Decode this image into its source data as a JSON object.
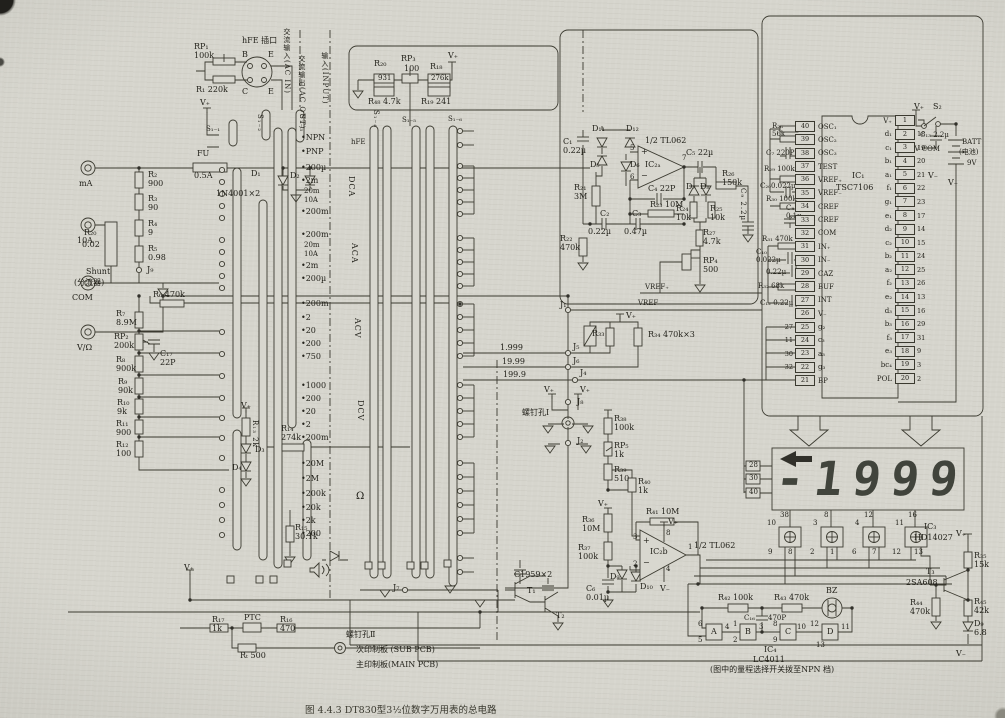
{
  "caption": "图 4.4.3   DT830型3½位数字万用表的总电路",
  "lcd": {
    "model": "LD-B7015A 型",
    "label": "LCD",
    "reading": "-1999"
  },
  "ic1": {
    "name": "IC₁",
    "part": "TSC7106",
    "left_pins": [
      {
        "n": "40",
        "l": "OSC₁"
      },
      {
        "n": "39",
        "l": "OSC₂"
      },
      {
        "n": "38",
        "l": "OSC₃"
      },
      {
        "n": "37",
        "l": "TEST"
      },
      {
        "n": "36",
        "l": "VREF₊"
      },
      {
        "n": "35",
        "l": "VREF₋"
      },
      {
        "n": "34",
        "l": "CREF"
      },
      {
        "n": "33",
        "l": "CREF"
      },
      {
        "n": "32",
        "l": "COM"
      },
      {
        "n": "31",
        "l": "IN₊"
      },
      {
        "n": "30",
        "l": "IN₋"
      },
      {
        "n": "29",
        "l": "CAZ"
      },
      {
        "n": "28",
        "l": "BUF"
      },
      {
        "n": "27",
        "l": "INT"
      },
      {
        "n": "26",
        "l": "V₋"
      },
      {
        "n": "25",
        "l": "g₂",
        "e": "27"
      },
      {
        "n": "24",
        "l": "c₃",
        "e": "11"
      },
      {
        "n": "23",
        "l": "a₃",
        "e": "30"
      },
      {
        "n": "22",
        "l": "g₃",
        "e": "32"
      },
      {
        "n": "21",
        "l": "BP"
      }
    ],
    "right_pins": [
      {
        "n": "1",
        "l": "V₊"
      },
      {
        "n": "2",
        "l": "d₁",
        "e": "18"
      },
      {
        "n": "3",
        "l": "c₁",
        "e": "19"
      },
      {
        "n": "4",
        "l": "b₁",
        "e": "20"
      },
      {
        "n": "5",
        "l": "a₁",
        "e": "21"
      },
      {
        "n": "6",
        "l": "f₁",
        "e": "22"
      },
      {
        "n": "7",
        "l": "g₁",
        "e": "23"
      },
      {
        "n": "8",
        "l": "e₁",
        "e": "17"
      },
      {
        "n": "9",
        "l": "d₂",
        "e": "14"
      },
      {
        "n": "10",
        "l": "c₂",
        "e": "15"
      },
      {
        "n": "11",
        "l": "b₂",
        "e": "24"
      },
      {
        "n": "12",
        "l": "a₂",
        "e": "25"
      },
      {
        "n": "13",
        "l": "f₂",
        "e": "26"
      },
      {
        "n": "14",
        "l": "e₂",
        "e": "13"
      },
      {
        "n": "15",
        "l": "d₃",
        "e": "16"
      },
      {
        "n": "16",
        "l": "b₃",
        "e": "29"
      },
      {
        "n": "17",
        "l": "f₃",
        "e": "31"
      },
      {
        "n": "18",
        "l": "e₃",
        "e": "9"
      },
      {
        "n": "19",
        "l": "bc₄",
        "e": "3"
      },
      {
        "n": "20",
        "l": "POL",
        "e": "2"
      }
    ]
  },
  "labels": [
    {
      "t": "FU",
      "x": 197,
      "y": 150
    },
    {
      "t": "0.5A",
      "x": 194,
      "y": 172
    },
    {
      "t": "mA",
      "x": 79,
      "y": 180
    },
    {
      "t": "D₁",
      "x": 251,
      "y": 170
    },
    {
      "t": "D₂",
      "x": 290,
      "y": 172
    },
    {
      "t": "1N4001×2",
      "x": 216,
      "y": 190
    },
    {
      "t": "10A",
      "x": 77,
      "y": 237
    },
    {
      "t": "R₂₀",
      "x": 84,
      "y": 229
    },
    {
      "t": "0.02",
      "x": 82,
      "y": 241
    },
    {
      "t": "Shunt",
      "x": 86,
      "y": 268
    },
    {
      "t": "(分流器)",
      "x": 74,
      "y": 279
    },
    {
      "t": "COM",
      "x": 72,
      "y": 294
    },
    {
      "t": "V/Ω",
      "x": 77,
      "y": 344
    },
    {
      "t": "R₂\n900",
      "x": 148,
      "y": 171
    },
    {
      "t": "R₃\n90",
      "x": 148,
      "y": 195
    },
    {
      "t": "R₄\n9",
      "x": 148,
      "y": 220
    },
    {
      "t": "R₅\n0.98",
      "x": 148,
      "y": 245
    },
    {
      "t": "J₉",
      "x": 147,
      "y": 266
    },
    {
      "t": "RP₁\n100k",
      "x": 194,
      "y": 43
    },
    {
      "t": "R₁ 220k",
      "x": 196,
      "y": 86
    },
    {
      "t": "hFE 插口",
      "x": 242,
      "y": 37
    },
    {
      "t": "B",
      "x": 242,
      "y": 51
    },
    {
      "t": "E",
      "x": 268,
      "y": 51
    },
    {
      "t": "C",
      "x": 242,
      "y": 88
    },
    {
      "t": "E",
      "x": 268,
      "y": 88
    },
    {
      "t": "交流输入(AC IN)",
      "x": 282,
      "y": 28,
      "v": 1,
      "f": 7
    },
    {
      "t": "交流输出(AC OUT)",
      "x": 297,
      "y": 55,
      "v": 1,
      "f": 7
    },
    {
      "t": "输入(INPUT)",
      "x": 320,
      "y": 52,
      "v": 1,
      "f": 7
    },
    {
      "t": "V₊",
      "x": 200,
      "y": 99
    },
    {
      "t": "S₁₋₁",
      "x": 206,
      "y": 126,
      "f": 7
    },
    {
      "t": "S₁₋₂",
      "x": 255,
      "y": 114,
      "v": 1,
      "f": 7
    },
    {
      "t": "S₁₋₃",
      "x": 297,
      "y": 114,
      "v": 1,
      "f": 7
    },
    {
      "t": "S₁₋₄",
      "x": 371,
      "y": 110,
      "v": 1,
      "f": 7
    },
    {
      "t": "S₁₋₅",
      "x": 402,
      "y": 117,
      "f": 7
    },
    {
      "t": "S₁₋₆",
      "x": 448,
      "y": 116,
      "f": 7
    },
    {
      "t": "•NPN",
      "x": 301,
      "y": 134
    },
    {
      "t": "•PNP",
      "x": 301,
      "y": 148
    },
    {
      "t": "hFE",
      "x": 351,
      "y": 139,
      "f": 7
    },
    {
      "t": "•200µ",
      "x": 301,
      "y": 164
    },
    {
      "t": "•2m",
      "x": 301,
      "y": 177
    },
    {
      "t": "20m",
      "x": 304,
      "y": 188,
      "f": 7
    },
    {
      "t": "10A",
      "x": 304,
      "y": 197,
      "f": 7
    },
    {
      "t": "•200m",
      "x": 301,
      "y": 208
    },
    {
      "t": "DCA",
      "x": 346,
      "y": 176,
      "v": 1
    },
    {
      "t": "•200m",
      "x": 301,
      "y": 231
    },
    {
      "t": "20m",
      "x": 304,
      "y": 242,
      "f": 7
    },
    {
      "t": "10A",
      "x": 304,
      "y": 251,
      "f": 7
    },
    {
      "t": "•2m",
      "x": 301,
      "y": 262
    },
    {
      "t": "•200µ",
      "x": 301,
      "y": 275
    },
    {
      "t": "ACA",
      "x": 349,
      "y": 243,
      "v": 1
    },
    {
      "t": "•200m",
      "x": 301,
      "y": 300
    },
    {
      "t": "•2",
      "x": 301,
      "y": 314
    },
    {
      "t": "•20",
      "x": 301,
      "y": 327
    },
    {
      "t": "•200",
      "x": 301,
      "y": 340
    },
    {
      "t": "•750",
      "x": 301,
      "y": 353
    },
    {
      "t": "ACV",
      "x": 352,
      "y": 318,
      "v": 1
    },
    {
      "t": "•1000",
      "x": 301,
      "y": 382
    },
    {
      "t": "•200",
      "x": 301,
      "y": 395
    },
    {
      "t": "•20",
      "x": 301,
      "y": 408
    },
    {
      "t": "•2",
      "x": 301,
      "y": 421
    },
    {
      "t": "•200m",
      "x": 301,
      "y": 434
    },
    {
      "t": "DCV",
      "x": 355,
      "y": 400,
      "v": 1
    },
    {
      "t": "•20M",
      "x": 301,
      "y": 460
    },
    {
      "t": "•2M",
      "x": 301,
      "y": 475
    },
    {
      "t": "•200k",
      "x": 301,
      "y": 490
    },
    {
      "t": "•20k",
      "x": 301,
      "y": 504
    },
    {
      "t": "•2k",
      "x": 301,
      "y": 517
    },
    {
      "t": "•200",
      "x": 301,
      "y": 530
    },
    {
      "t": "Ω",
      "x": 356,
      "y": 491,
      "f": 10
    },
    {
      "t": "R₇\n8.9M",
      "x": 116,
      "y": 310
    },
    {
      "t": "RP₂\n200k",
      "x": 114,
      "y": 333
    },
    {
      "t": "R₈\n900k",
      "x": 116,
      "y": 356
    },
    {
      "t": "R₉\n90k",
      "x": 118,
      "y": 378
    },
    {
      "t": "R₁₀\n9k",
      "x": 117,
      "y": 399
    },
    {
      "t": "R₁₁\n900",
      "x": 116,
      "y": 420
    },
    {
      "t": "R₁₂\n100",
      "x": 116,
      "y": 441
    },
    {
      "t": "R₆ 470k",
      "x": 153,
      "y": 291
    },
    {
      "t": "C₁₇\n22P",
      "x": 160,
      "y": 350
    },
    {
      "t": "V₊",
      "x": 241,
      "y": 402
    },
    {
      "t": "R₁₃ 2k",
      "x": 250,
      "y": 420,
      "v": 1,
      "f": 7
    },
    {
      "t": "D₃",
      "x": 255,
      "y": 446
    },
    {
      "t": "D₄",
      "x": 232,
      "y": 464
    },
    {
      "t": "R₁₄\n274k",
      "x": 281,
      "y": 425
    },
    {
      "t": "R₁₅\n30.1k",
      "x": 295,
      "y": 524
    },
    {
      "t": "J₇",
      "x": 393,
      "y": 584
    },
    {
      "t": "V₊",
      "x": 184,
      "y": 564
    },
    {
      "t": "R₂₀",
      "x": 374,
      "y": 60
    },
    {
      "t": "931",
      "x": 378,
      "y": 75,
      "f": 7
    },
    {
      "t": "RP₃",
      "x": 401,
      "y": 55
    },
    {
      "t": "100",
      "x": 404,
      "y": 65
    },
    {
      "t": "R₁₈",
      "x": 430,
      "y": 63
    },
    {
      "t": "276k",
      "x": 431,
      "y": 75,
      "f": 7
    },
    {
      "t": "R₄₈ 4.7k",
      "x": 368,
      "y": 98
    },
    {
      "t": "R₁₉ 241",
      "x": 421,
      "y": 98
    },
    {
      "t": "V₊",
      "x": 448,
      "y": 52
    },
    {
      "t": "D₁₁",
      "x": 592,
      "y": 125
    },
    {
      "t": "D₁₂",
      "x": 626,
      "y": 125
    },
    {
      "t": "C₁\n0.22µ",
      "x": 563,
      "y": 138
    },
    {
      "t": "D₅",
      "x": 590,
      "y": 161
    },
    {
      "t": "D₆",
      "x": 630,
      "y": 161
    },
    {
      "t": "1/2 TL062",
      "x": 645,
      "y": 137
    },
    {
      "t": "5",
      "x": 630,
      "y": 145,
      "f": 7
    },
    {
      "t": "+",
      "x": 641,
      "y": 148
    },
    {
      "t": "IC₂ₐ",
      "x": 645,
      "y": 161
    },
    {
      "t": "6",
      "x": 630,
      "y": 174,
      "f": 7
    },
    {
      "t": "−",
      "x": 641,
      "y": 172
    },
    {
      "t": "7",
      "x": 682,
      "y": 155,
      "f": 7
    },
    {
      "t": "C₅ 22µ",
      "x": 686,
      "y": 149
    },
    {
      "t": "C₄ 22P",
      "x": 648,
      "y": 185
    },
    {
      "t": "R₂₃ 10M",
      "x": 650,
      "y": 201
    },
    {
      "t": "R₂₁\n3M",
      "x": 574,
      "y": 184
    },
    {
      "t": "C₂",
      "x": 600,
      "y": 210
    },
    {
      "t": "0.22µ",
      "x": 588,
      "y": 228
    },
    {
      "t": "C₃",
      "x": 632,
      "y": 210
    },
    {
      "t": "0.47µ",
      "x": 624,
      "y": 228
    },
    {
      "t": "R₂₂\n470k",
      "x": 560,
      "y": 235
    },
    {
      "t": "D₇",
      "x": 686,
      "y": 183
    },
    {
      "t": "D₈",
      "x": 700,
      "y": 183
    },
    {
      "t": "R₂₆\n150k",
      "x": 722,
      "y": 170
    },
    {
      "t": "R₂₄\n10k",
      "x": 676,
      "y": 205
    },
    {
      "t": "R₂₅\n10k",
      "x": 710,
      "y": 205
    },
    {
      "t": "R₂₇\n4.7k",
      "x": 703,
      "y": 229
    },
    {
      "t": "RP₄\n500",
      "x": 703,
      "y": 257
    },
    {
      "t": "C₉ 2.2µ",
      "x": 738,
      "y": 188,
      "v": 1,
      "f": 7
    },
    {
      "t": "VREF₊",
      "x": 645,
      "y": 284,
      "f": 7
    },
    {
      "t": "VREF₋",
      "x": 638,
      "y": 300,
      "f": 7
    },
    {
      "t": "J₁",
      "x": 560,
      "y": 301
    },
    {
      "t": "1.999",
      "x": 500,
      "y": 344
    },
    {
      "t": "J₅",
      "x": 573,
      "y": 343
    },
    {
      "t": "19.99",
      "x": 502,
      "y": 358
    },
    {
      "t": "J₆",
      "x": 573,
      "y": 357
    },
    {
      "t": "199.9",
      "x": 503,
      "y": 371
    },
    {
      "t": "J₄",
      "x": 580,
      "y": 369
    },
    {
      "t": "V₊",
      "x": 626,
      "y": 312
    },
    {
      "t": "R₃₃",
      "x": 592,
      "y": 330
    },
    {
      "t": "R₃₄ 470k×3",
      "x": 648,
      "y": 331
    },
    {
      "t": "V₊",
      "x": 544,
      "y": 386
    },
    {
      "t": "V₊",
      "x": 580,
      "y": 386
    },
    {
      "t": "J₈",
      "x": 577,
      "y": 398
    },
    {
      "t": "螺钉孔Ⅰ",
      "x": 522,
      "y": 409
    },
    {
      "t": "J₂",
      "x": 577,
      "y": 437
    },
    {
      "t": "R₃₈\n100k",
      "x": 614,
      "y": 415
    },
    {
      "t": "RP₅\n1k",
      "x": 614,
      "y": 442
    },
    {
      "t": "R₃₉\n510",
      "x": 614,
      "y": 466
    },
    {
      "t": "R₄₀\n1k",
      "x": 638,
      "y": 478
    },
    {
      "t": "V₊",
      "x": 598,
      "y": 500
    },
    {
      "t": "R₃₆\n10M",
      "x": 582,
      "y": 516
    },
    {
      "t": "R₃₇\n100k",
      "x": 578,
      "y": 544
    },
    {
      "t": "R₄₁ 10M",
      "x": 646,
      "y": 508
    },
    {
      "t": "IC₂b",
      "x": 650,
      "y": 548
    },
    {
      "t": "3",
      "x": 633,
      "y": 534,
      "f": 7
    },
    {
      "t": "+",
      "x": 643,
      "y": 537
    },
    {
      "t": "2",
      "x": 633,
      "y": 561,
      "f": 7
    },
    {
      "t": "−",
      "x": 643,
      "y": 559
    },
    {
      "t": "8",
      "x": 666,
      "y": 530,
      "f": 7
    },
    {
      "t": "4",
      "x": 666,
      "y": 566,
      "f": 7
    },
    {
      "t": "1",
      "x": 688,
      "y": 544,
      "f": 7
    },
    {
      "t": "1/2 TL062",
      "x": 694,
      "y": 542
    },
    {
      "t": "V₊",
      "x": 668,
      "y": 518
    },
    {
      "t": "V₋",
      "x": 660,
      "y": 585
    },
    {
      "t": "D₉",
      "x": 610,
      "y": 573
    },
    {
      "t": "D₁₀",
      "x": 640,
      "y": 583
    },
    {
      "t": "C₆\n0.01µ",
      "x": 586,
      "y": 585
    },
    {
      "t": "R₄₂ 100k",
      "x": 718,
      "y": 594
    },
    {
      "t": "R₄₃ 470k",
      "x": 774,
      "y": 594
    },
    {
      "t": "C₁₆",
      "x": 744,
      "y": 615,
      "f": 7
    },
    {
      "t": "470P",
      "x": 768,
      "y": 615,
      "f": 7
    },
    {
      "t": "BZ",
      "x": 826,
      "y": 587
    },
    {
      "t": "6",
      "x": 698,
      "y": 621,
      "f": 7
    },
    {
      "t": "5",
      "x": 698,
      "y": 637,
      "f": 7
    },
    {
      "t": "A",
      "x": 711,
      "y": 628
    },
    {
      "t": "4",
      "x": 725,
      "y": 624,
      "f": 7
    },
    {
      "t": "1",
      "x": 733,
      "y": 621,
      "f": 7
    },
    {
      "t": "2",
      "x": 733,
      "y": 637,
      "f": 7
    },
    {
      "t": "B",
      "x": 745,
      "y": 628
    },
    {
      "t": "3",
      "x": 759,
      "y": 624,
      "f": 7
    },
    {
      "t": "8",
      "x": 773,
      "y": 621,
      "f": 7
    },
    {
      "t": "9",
      "x": 773,
      "y": 637,
      "f": 7
    },
    {
      "t": "C",
      "x": 785,
      "y": 628
    },
    {
      "t": "10",
      "x": 797,
      "y": 624,
      "f": 7
    },
    {
      "t": "12",
      "x": 810,
      "y": 621,
      "f": 7
    },
    {
      "t": "13",
      "x": 816,
      "y": 642,
      "f": 7
    },
    {
      "t": "D",
      "x": 827,
      "y": 628
    },
    {
      "t": "11",
      "x": 841,
      "y": 624,
      "f": 7
    },
    {
      "t": "IC₄",
      "x": 764,
      "y": 646
    },
    {
      "t": "LC4011",
      "x": 753,
      "y": 656
    },
    {
      "t": "(图中的量程选择开关拨至NPN 档)",
      "x": 710,
      "y": 666,
      "f": 8
    },
    {
      "t": "IC₃",
      "x": 924,
      "y": 523
    },
    {
      "t": "HD14027",
      "x": 914,
      "y": 534
    },
    {
      "t": "V₊",
      "x": 956,
      "y": 530
    },
    {
      "t": "R₃₅\n15k",
      "x": 974,
      "y": 552
    },
    {
      "t": "T₃",
      "x": 926,
      "y": 568
    },
    {
      "t": "2SA608",
      "x": 906,
      "y": 579
    },
    {
      "t": "R₄₄\n470k",
      "x": 910,
      "y": 599
    },
    {
      "t": "R₄₅\n42k",
      "x": 974,
      "y": 598
    },
    {
      "t": "D₉\n6.8",
      "x": 974,
      "y": 620
    },
    {
      "t": "V₋",
      "x": 956,
      "y": 650
    },
    {
      "t": "V₊",
      "x": 914,
      "y": 103
    },
    {
      "t": "S₂",
      "x": 933,
      "y": 103
    },
    {
      "t": "C₁₃ 2.2µ",
      "x": 920,
      "y": 132,
      "f": 7
    },
    {
      "t": "9V COM",
      "x": 910,
      "y": 146,
      "f": 7
    },
    {
      "t": "BATT",
      "x": 962,
      "y": 139,
      "f": 7
    },
    {
      "t": "(电池)",
      "x": 959,
      "y": 149,
      "f": 7
    },
    {
      "t": "9V",
      "x": 967,
      "y": 160,
      "f": 7
    },
    {
      "t": "V₋",
      "x": 928,
      "y": 172
    },
    {
      "t": "V₋",
      "x": 948,
      "y": 179
    },
    {
      "t": "R₂₈\n56k",
      "x": 772,
      "y": 123,
      "f": 7
    },
    {
      "t": "C₇ 220P",
      "x": 766,
      "y": 150,
      "f": 7
    },
    {
      "t": "R₂₉ 100k",
      "x": 764,
      "y": 166,
      "f": 7
    },
    {
      "t": "C₂₀0.022µ",
      "x": 760,
      "y": 183,
      "f": 7
    },
    {
      "t": "R₃₀ 100k",
      "x": 766,
      "y": 196,
      "f": 7
    },
    {
      "t": "C₈\n0.1µ",
      "x": 786,
      "y": 205,
      "f": 7
    },
    {
      "t": "R₃₁ 470k",
      "x": 762,
      "y": 236,
      "f": 7
    },
    {
      "t": "C₁₀\n0.022µ",
      "x": 756,
      "y": 249,
      "f": 7
    },
    {
      "t": "0.22µ",
      "x": 766,
      "y": 269,
      "f": 7
    },
    {
      "t": "R₃₂ 68k",
      "x": 758,
      "y": 283,
      "f": 7
    },
    {
      "t": "C₁₂ 0.22µ",
      "x": 760,
      "y": 300,
      "f": 7
    },
    {
      "t": "28",
      "x": 749,
      "y": 462,
      "f": 7
    },
    {
      "t": "30",
      "x": 749,
      "y": 475,
      "f": 7
    },
    {
      "t": "40",
      "x": 749,
      "y": 489,
      "f": 7
    },
    {
      "t": "38",
      "x": 780,
      "y": 512,
      "f": 7
    },
    {
      "t": "8",
      "x": 824,
      "y": 512,
      "f": 7
    },
    {
      "t": "12",
      "x": 864,
      "y": 512,
      "f": 7
    },
    {
      "t": "16",
      "x": 908,
      "y": 512,
      "f": 7
    },
    {
      "t": "10",
      "x": 767,
      "y": 520,
      "f": 7
    },
    {
      "t": "3",
      "x": 813,
      "y": 520,
      "f": 7
    },
    {
      "t": "4",
      "x": 855,
      "y": 520,
      "f": 7
    },
    {
      "t": "11",
      "x": 895,
      "y": 520,
      "f": 7
    },
    {
      "t": "9",
      "x": 768,
      "y": 549,
      "f": 7
    },
    {
      "t": "8",
      "x": 788,
      "y": 549,
      "f": 7
    },
    {
      "t": "2",
      "x": 810,
      "y": 549,
      "f": 7
    },
    {
      "t": "1",
      "x": 830,
      "y": 549,
      "f": 7
    },
    {
      "t": "6",
      "x": 852,
      "y": 549,
      "f": 7
    },
    {
      "t": "7",
      "x": 872,
      "y": 549,
      "f": 7
    },
    {
      "t": "12",
      "x": 892,
      "y": 549,
      "f": 7
    },
    {
      "t": "13",
      "x": 914,
      "y": 549,
      "f": 7
    },
    {
      "t": "R₁₇\n1k",
      "x": 212,
      "y": 616
    },
    {
      "t": "PTC",
      "x": 244,
      "y": 614
    },
    {
      "t": "R₁₆\n470",
      "x": 280,
      "y": 616
    },
    {
      "t": "Rₜ 500",
      "x": 240,
      "y": 652
    },
    {
      "t": "螺钉孔Ⅱ",
      "x": 346,
      "y": 631
    },
    {
      "t": "次印制板 (SUB PCB)",
      "x": 356,
      "y": 646
    },
    {
      "t": "主印制板(MAIN PCB)",
      "x": 356,
      "y": 661
    },
    {
      "t": "C1959×2",
      "x": 514,
      "y": 571
    },
    {
      "t": "T₁",
      "x": 527,
      "y": 587
    },
    {
      "t": "T₂",
      "x": 556,
      "y": 612
    }
  ]
}
